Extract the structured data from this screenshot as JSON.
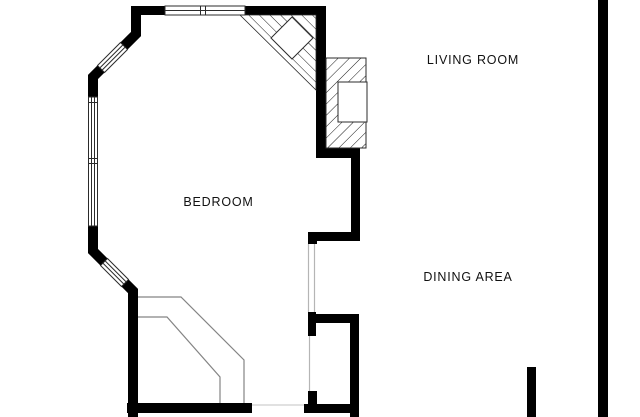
{
  "rooms": [
    {
      "id": "bedroom",
      "label": "BEDROOM"
    },
    {
      "id": "living-room",
      "label": "LIVING ROOM"
    },
    {
      "id": "dining-area",
      "label": "DINING AREA"
    }
  ],
  "colors": {
    "background": "#ffffff",
    "wall": "#000000",
    "thin_outline": "#2b2b2b",
    "stair_outline": "#848484",
    "opening_line": "#b5b5b5",
    "threshold_line": "#cfcfcf",
    "label_text": "#111111"
  }
}
